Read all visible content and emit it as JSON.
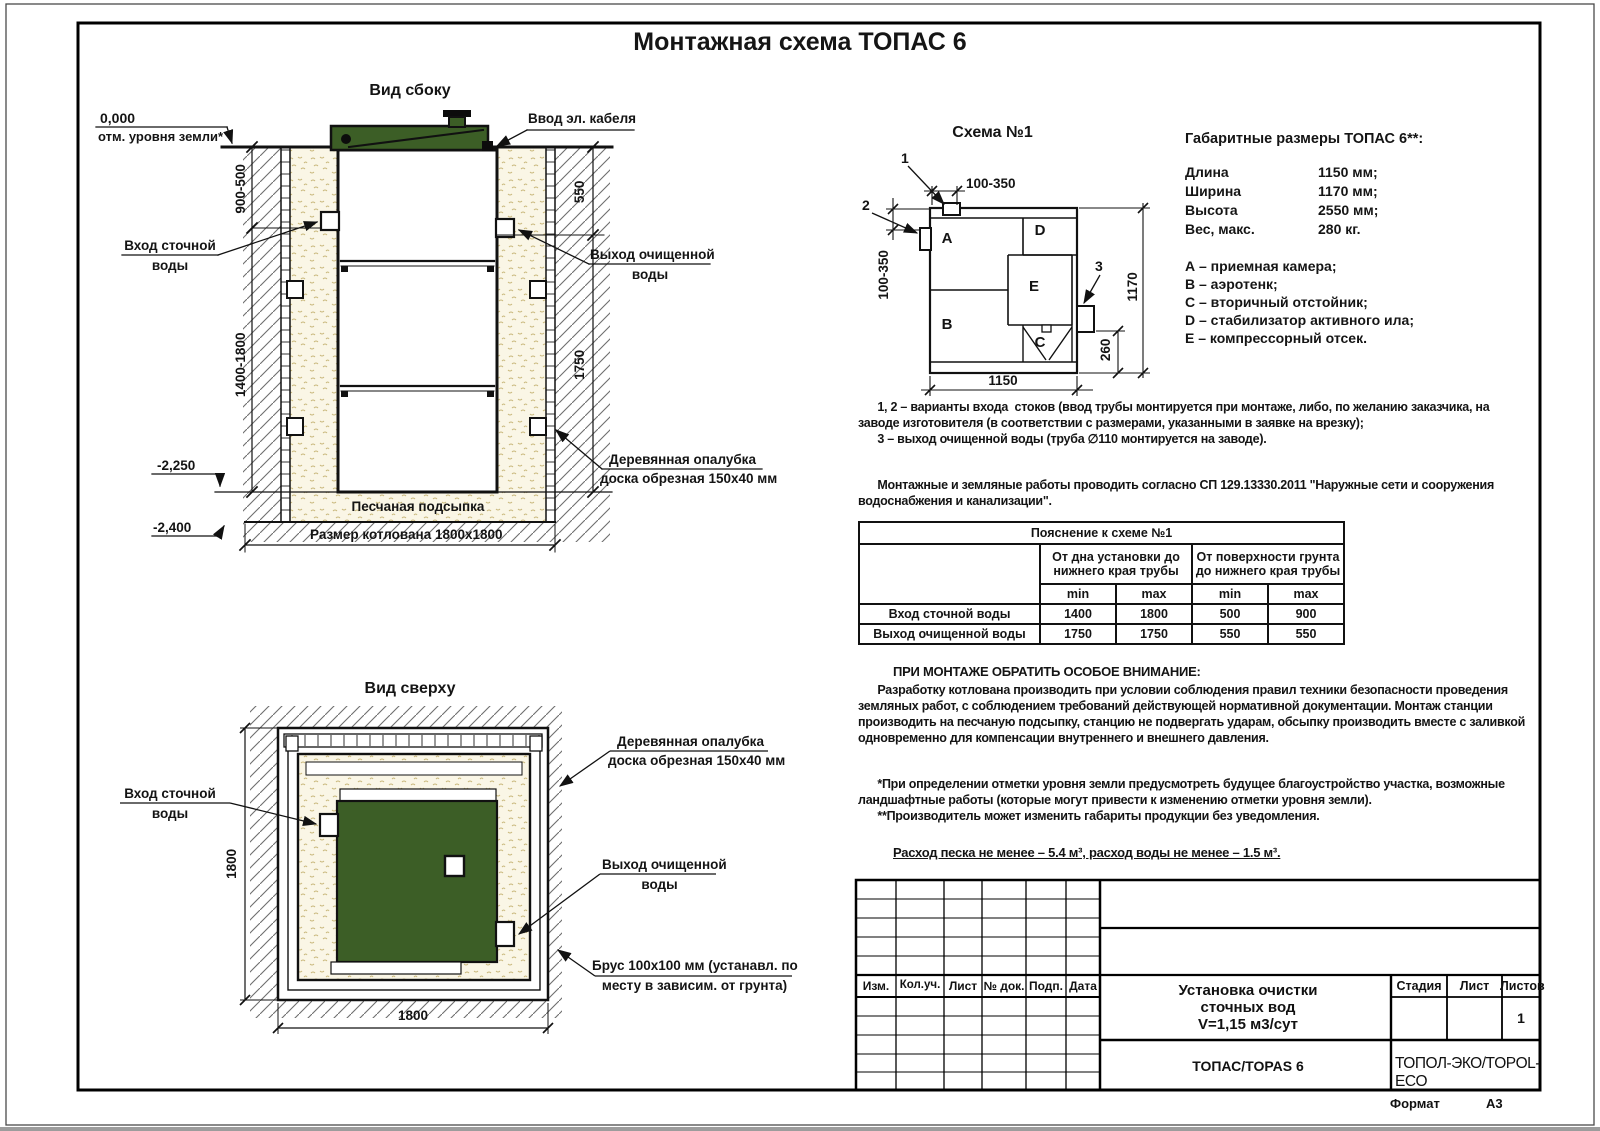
{
  "page_title": "Монтажная схема ТОПАС 6",
  "colors": {
    "green": "#3c5e26",
    "sand_bg": "#faf6e6",
    "line": "#111111"
  },
  "shared_labels": {
    "inlet_1": "Вход сточной",
    "inlet_2": "воды",
    "outlet_1": "Выход очищенной",
    "outlet_2": "воды",
    "formwork_1": "Деревянная опалубка",
    "formwork_2": "доска обрезная 150х40 мм"
  },
  "side_view": {
    "title": "Вид сбоку",
    "level_zero": "0,000",
    "level_zero_note": "отм. уровня земли*",
    "cable_label": "Ввод эл. кабеля",
    "dim_depth_top": "900-500",
    "dim_depth_bottom": "1400-1800",
    "dim_550": "550",
    "dim_1750": "1750",
    "level_2250": "-2,250",
    "level_2400": "-2,400",
    "sand_label": "Песчаная подсыпка",
    "pit_label": "Размер котлована 1800х1800"
  },
  "top_view": {
    "title": "Вид сверху",
    "dim_left": "1800",
    "dim_bottom": "1800",
    "brus_1": "Брус 100х100 мм (устанавл. по",
    "brus_2": "месту в зависим. от грунта)"
  },
  "scheme": {
    "title": "Схема №1",
    "marker_1": "1",
    "marker_2": "2",
    "marker_3": "3",
    "dim_top": "100-350",
    "dim_left": "100-350",
    "dim_bottom": "1150",
    "dim_right": "1170",
    "dim_260": "260",
    "comp_a": "A",
    "comp_b": "B",
    "comp_c": "C",
    "comp_d": "D",
    "comp_e": "E"
  },
  "specs": {
    "heading": "Габаритные размеры ТОПАС 6**:",
    "rows": [
      {
        "label": "Длина",
        "value": "1150 мм;"
      },
      {
        "label": "Ширина",
        "value": "1170 мм;"
      },
      {
        "label": "Высота",
        "value": "2550 мм;"
      },
      {
        "label": "Вес, макс.",
        "value": "280 кг."
      }
    ]
  },
  "legend": [
    "А – приемная камера;",
    "В – аэротенк;",
    "С – вторичный отстойник;",
    "D – стабилизатор активного ила;",
    "Е – компрессорный отсек."
  ],
  "notes": "      1, 2 – варианты входа  стоков (ввод трубы монтируется при монтаже, либо, по желанию заказчика, на\nзаводе изготовителя (в соответствии с размерами, указанными в заявке на врезку);\n      3 – выход очищенной воды (труба ∅110 монтируется на заводе).",
  "sp_note": "      Монтажные и земляные работы проводить согласно СП 129.13330.2011 \"Наружные сети и сооружения\nводоснабжения и канализации\".",
  "table": {
    "title": "Пояснение к схеме №1",
    "group1": "От дна установки до\nнижнего края трубы",
    "group2": "От поверхности грунта\nдо нижнего края трубы",
    "min1": "min",
    "max1": "max",
    "min2": "min",
    "max2": "max",
    "rows": [
      {
        "label": "Вход сточной воды",
        "v1": "1400",
        "v2": "1800",
        "v3": "500",
        "v4": "900"
      },
      {
        "label": "Выход очищенной воды",
        "v1": "1750",
        "v2": "1750",
        "v3": "550",
        "v4": "550"
      }
    ]
  },
  "attention_title": "ПРИ МОНТАЖЕ ОБРАТИТЬ ОСОБОЕ ВНИМАНИЕ:",
  "attention_body": "      Разработку котлована производить при условии соблюдения правил техники безопасности проведения\nземляных работ, с соблюдением требований действующей нормативной документации. Монтаж станции\nпроизводить на песчаную подсыпку, станцию не подвергать ударам, обсыпку производить вместе с заливкой\nодновременно для компенсации внутреннего и внешнего давления.",
  "footnotes": "      *При определении отметки уровня земли предусмотреть будущее благоустройство участка, возможные\nландшафтные работы (которые могут привести к изменению отметки уровня земли).\n      **Производитель может изменить габариты продукции без уведомления.",
  "consumption": "Расход песка не менее – 5.4 м³, расход воды не менее – 1.5 м³.",
  "title_block": {
    "cols": [
      "Изм.",
      "Кол.уч.",
      "Лист",
      "№ док.",
      "Подп.",
      "Дата"
    ],
    "stage_cols": [
      "Стадия",
      "Лист",
      "Листов"
    ],
    "sheets_value": "1",
    "project": "Установка очистки\nсточных вод\nV=1,15 м3/сут",
    "model": "ТОПАС/TOPAS 6",
    "company": "ТОПОЛ-ЭКО/TOPOL-ECO",
    "format_label": "Формат",
    "format_value": "А3"
  }
}
